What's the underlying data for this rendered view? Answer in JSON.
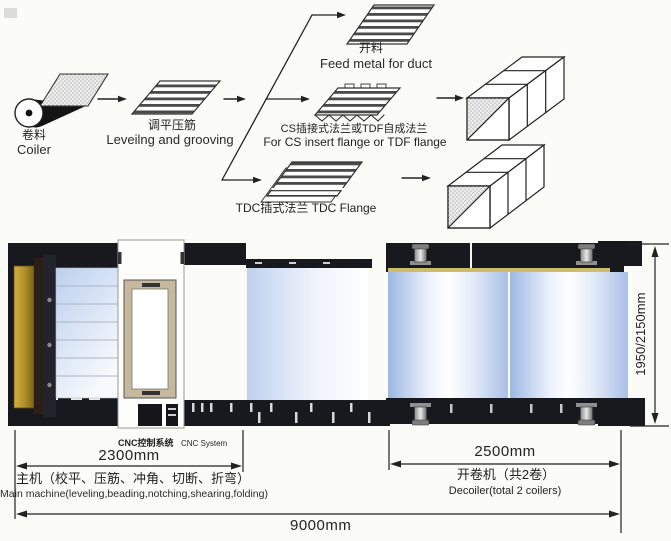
{
  "flow": {
    "coiler": {
      "zh": "卷料",
      "en": "Coiler"
    },
    "leveling": {
      "zh": "调平压筋",
      "en": "Leveilng and grooving"
    },
    "feed": {
      "zh": "开料",
      "en": "Feed metal for duct"
    },
    "cs": {
      "zh": "CS插接式法兰或TDF自成法兰",
      "en": "For CS insert flange or TDF flange"
    },
    "tdc": {
      "label": "TDC插式法兰 TDC Flange"
    }
  },
  "machine": {
    "cnc": {
      "zh": "CNC控制系统",
      "en": "CNC System"
    },
    "main": {
      "zh": "主机（校平、压筋、冲角、切断、折弯）",
      "en": "Main machine(leveling,beading,notching,shearing,folding)"
    },
    "decoiler": {
      "zh": "开卷机（共2卷）",
      "en": "Decoiler(total 2 coilers)"
    },
    "dimensions": {
      "main_length": "2300mm",
      "decoiler_length": "2500mm",
      "total_length": "9000mm",
      "height": "1950/2150mm"
    }
  },
  "colors": {
    "frame_dark": "#18181f",
    "accent_gold": "#b8952a",
    "coil_blue": "#a9bfe7",
    "panel_tan": "#c6b89c",
    "line_ink": "#222222"
  }
}
